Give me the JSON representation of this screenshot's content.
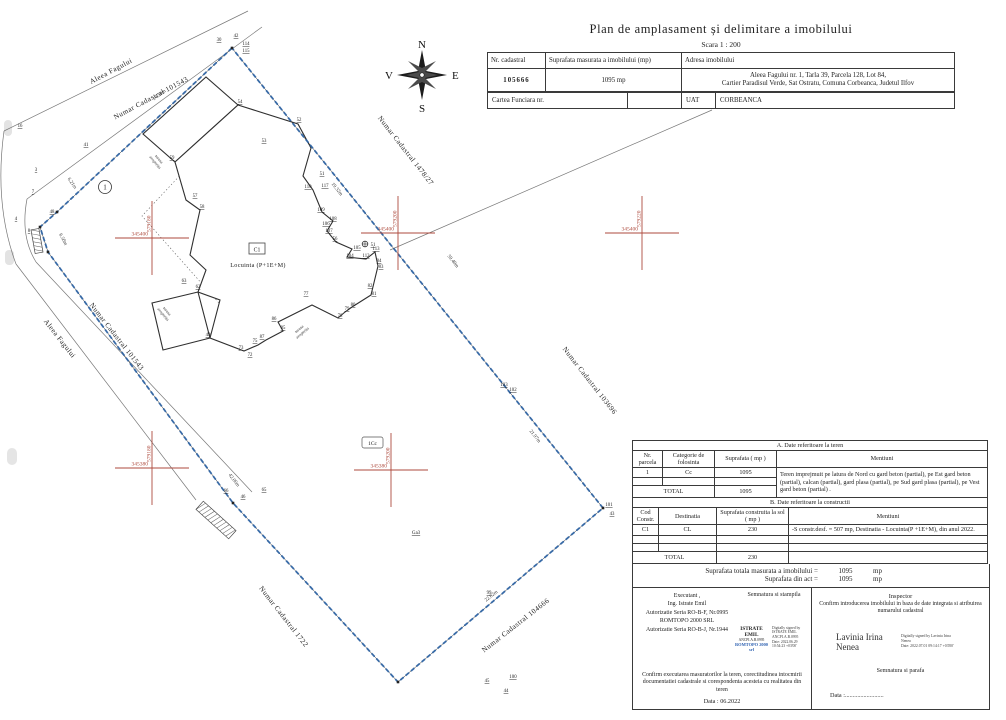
{
  "header": {
    "title": "Plan de amplasament și delimitare a imobilului",
    "scale": "Scara 1 : 200"
  },
  "top_table": {
    "col_nr_cadastral": "Nr. cadastral",
    "col_suprafata": "Suprafata masurata a imobilului (mp)",
    "col_adresa": "Adresa  imobilului",
    "nr_cadastral": "105666",
    "suprafata": "1095 mp",
    "adresa_line1": "Aleea Fagului nr. 1, Tarla 39, Parcela 128, Lot 84,",
    "adresa_line2": "Cartier Paradisul Verde, Sat Ostratu, Comuna Corbeanca, Judetul Ilfov",
    "cartea_funciara_label": "Cartea Funciara  nr.",
    "uat_label": "UAT",
    "uat_value": "CORBEANCA"
  },
  "compass": {
    "n": "N",
    "s": "S",
    "e": "E",
    "w": "V"
  },
  "table_a": {
    "title": "A. Date referitoare la teren",
    "headers": [
      "Nr. parcela",
      "Categorie de folosinta",
      "Suprafata ( mp )",
      "Mentiuni"
    ],
    "rows": [
      [
        "1",
        "Cc",
        "1095",
        "Teren imprejmuit pe latura de Nord cu gard beton (partial), pe Est gard beton (partial), calcan (partial), gard plasa (partial), pe Sud gard plasa (partial), pe Vest gard beton (partial) ."
      ]
    ],
    "total_label": "TOTAL",
    "total_value": "1095"
  },
  "table_b": {
    "title": "B. Date referitoare la constructii",
    "headers": [
      "Cod Constr.",
      "Destinatia",
      "Suprafata construita la sol ( mp )",
      "Mentiuni"
    ],
    "rows": [
      [
        "C1",
        "CL",
        "230",
        "-S constr.desf. = 507 mp, Destinatia - Locuinta(P +1E+M), din anul 2022."
      ]
    ],
    "total_label": "TOTAL",
    "total_value": "230"
  },
  "totals": {
    "line1_label": "Suprafata totala masurata a imobilului =",
    "line1_value": "1095",
    "line1_unit": "mp",
    "line2_label": "Suprafata din act =",
    "line2_value": "1095",
    "line2_unit": "mp"
  },
  "signatures": {
    "executant": {
      "lines": [
        "Executant ,",
        "Ing. Istrate Emil",
        "Autorizatie Seria RO-B-F, Nr.0995",
        "ROMTOPO 2000 SRL",
        "Autorizatie Seria RO-B-J, Nr.1944"
      ],
      "semnatura_label": "Semnatura si stampila",
      "stamp_name": "ISTRATE EMIL",
      "stamp_id": "ANCPI.A.B.0995",
      "stamp_company": "ROMTOPO 2000 srl",
      "stamp_details": "Digitally signed by ISTRATE EMIL ANCPI.A.B.0995",
      "stamp_date": "Date: 2022.06.29 10:54:23 +03'00'",
      "confirm_text": "Confirm executarea masuratorilor la teren, corectitudinea intocmirii documentatiei cadastrale si corespondenta acesteia cu realitatea din teren",
      "data_label": "Data :",
      "data_value": "06.2022"
    },
    "inspector": {
      "title": "Inspector",
      "confirm_text": "Confirm introducerea imobilului in baza de date integrata si atribuirea numarului cadastral",
      "sign_name": "Lavinia Irina Nenea",
      "sign_details": "Digitally signed by Lavinia Irina Nenea",
      "sign_date": "Date: 2022.07.01 09:14:17 +03'00'",
      "semnatura_label": "Semnatura si parafa",
      "data_label": "Data :........................."
    }
  },
  "plan": {
    "colors": {
      "boundary": "#2e64a5",
      "cross": "#ad4a3d",
      "road": "#777777",
      "building": "#2f2f2f"
    },
    "boundary": [
      [
        232,
        48
      ],
      [
        57,
        212
      ],
      [
        40,
        227
      ],
      [
        48,
        252
      ],
      [
        233,
        503
      ],
      [
        398,
        682
      ],
      [
        603,
        508
      ]
    ],
    "roads": [
      [
        [
          4,
          131
        ],
        [
          248,
          11
        ]
      ],
      [
        [
          27,
          199
        ],
        [
          262,
          27
        ]
      ],
      [
        [
          16,
          264
        ],
        [
          196,
          500
        ]
      ],
      [
        [
          36,
          262
        ],
        [
          252,
          492
        ]
      ],
      [
        [
          390,
          250
        ],
        [
          712,
          110
        ]
      ]
    ],
    "road_curves": [
      "M 4 131 Q -6 205 16 264",
      "M 27 199 Q 20 236 36 262"
    ],
    "culverts": [
      {
        "x": 216,
        "y": 520,
        "l": 44,
        "w": 11,
        "rot": 42
      },
      {
        "x": 37,
        "y": 241,
        "l": 24,
        "w": 8,
        "rot": 80
      }
    ],
    "building": {
      "main": [
        [
          238,
          105
        ],
        [
          298,
          124
        ],
        [
          311,
          148
        ],
        [
          303,
          176
        ],
        [
          313,
          190
        ],
        [
          322,
          212
        ],
        [
          333,
          221
        ],
        [
          327,
          231
        ],
        [
          336,
          242
        ],
        [
          352,
          249
        ],
        [
          347,
          257
        ],
        [
          366,
          259
        ],
        [
          375,
          252
        ],
        [
          378,
          266
        ],
        [
          371,
          295
        ],
        [
          352,
          307
        ],
        [
          345,
          312
        ],
        [
          338,
          318
        ],
        [
          312,
          305
        ],
        [
          278,
          322
        ],
        [
          283,
          331
        ],
        [
          266,
          340
        ],
        [
          258,
          345
        ],
        [
          244,
          351
        ],
        [
          210,
          338
        ],
        [
          220,
          300
        ],
        [
          198,
          292
        ],
        [
          206,
          270
        ],
        [
          190,
          255
        ],
        [
          200,
          210
        ],
        [
          186,
          200
        ],
        [
          175,
          162
        ]
      ],
      "wings": [
        [
          [
            175,
            162
          ],
          [
            238,
            105
          ],
          [
            206,
            77
          ],
          [
            143,
            134
          ]
        ],
        [
          [
            210,
            338
          ],
          [
            198,
            292
          ],
          [
            152,
            303
          ],
          [
            163,
            350
          ]
        ]
      ],
      "dotted": [
        [
          230,
          122
        ],
        [
          345,
          252
        ],
        [
          257,
          346
        ],
        [
          142,
          216
        ]
      ]
    },
    "crosses": [
      {
        "x": 152,
        "y": 238,
        "h": "345400",
        "v": "579180"
      },
      {
        "x": 398,
        "y": 233,
        "h": "345400",
        "v": "579200"
      },
      {
        "x": 642,
        "y": 233,
        "h": "345400",
        "v": "579220"
      },
      {
        "x": 152,
        "y": 468,
        "h": "345380",
        "v": "579180"
      },
      {
        "x": 391,
        "y": 470,
        "h": "345380",
        "v": "579200"
      }
    ],
    "parcel_texts": [
      [
        "Aleea Fagului",
        112,
        73,
        -28
      ],
      [
        "Numar Cadastral 101543",
        152,
        100,
        -28
      ],
      [
        "Aleea Fagului",
        58,
        340,
        52
      ],
      [
        "Numar Cadastral 101543",
        115,
        338,
        52
      ],
      [
        "Numar Cadastral 1478/27",
        404,
        152,
        52
      ],
      [
        "Numar Cadastral 103696",
        588,
        382,
        52
      ],
      [
        "Numar Cadastral 104666",
        517,
        627,
        -38
      ],
      [
        "Numar Cadastral 1722",
        282,
        618,
        52
      ]
    ],
    "dimensions": [
      [
        "14.50m",
        160,
        96,
        -37
      ],
      [
        "6.21m",
        71,
        184,
        55
      ],
      [
        "6.50m",
        62,
        240,
        62
      ],
      [
        "19.32m",
        336,
        190,
        51
      ],
      [
        "59.40m",
        452,
        262,
        51
      ],
      [
        "21.97m",
        534,
        437,
        51
      ],
      [
        "22.02m",
        492,
        597,
        -39
      ],
      [
        "42.06m",
        233,
        481,
        52
      ]
    ],
    "points": [
      [
        "16",
        20,
        127
      ],
      [
        "41",
        86,
        146
      ],
      [
        "3",
        36,
        171
      ],
      [
        "7",
        33,
        193
      ],
      [
        "48",
        52,
        213
      ],
      [
        "4",
        16,
        220
      ],
      [
        "8",
        29,
        232
      ],
      [
        "30",
        219,
        41
      ],
      [
        "42",
        236,
        37
      ],
      [
        "114",
        246,
        45
      ],
      [
        "115",
        246,
        52
      ],
      [
        "54",
        240,
        103
      ],
      [
        "52",
        299,
        121
      ],
      [
        "53",
        264,
        142
      ],
      [
        "59",
        172,
        159
      ],
      [
        "57",
        195,
        197
      ],
      [
        "58",
        202,
        208
      ],
      [
        "51",
        322,
        175
      ],
      [
        "110",
        308,
        188
      ],
      [
        "117",
        325,
        187
      ],
      [
        "109",
        321,
        211
      ],
      [
        "108",
        333,
        220
      ],
      [
        "106",
        326,
        225
      ],
      [
        "107",
        329,
        232
      ],
      [
        "56",
        335,
        240
      ],
      [
        "105",
        357,
        249
      ],
      [
        "104",
        350,
        257
      ],
      [
        "112",
        366,
        257
      ],
      [
        "113",
        376,
        250
      ],
      [
        "84",
        379,
        262
      ],
      [
        "83",
        381,
        268
      ],
      [
        "82",
        370,
        287
      ],
      [
        "81",
        374,
        295
      ],
      [
        "80",
        353,
        306
      ],
      [
        "79",
        347,
        310
      ],
      [
        "78",
        340,
        317
      ],
      [
        "77",
        306,
        295
      ],
      [
        "86",
        274,
        320
      ],
      [
        "85",
        283,
        329
      ],
      [
        "87",
        262,
        338
      ],
      [
        "75",
        255,
        342
      ],
      [
        "73",
        241,
        349
      ],
      [
        "72",
        250,
        356
      ],
      [
        "49",
        208,
        336
      ],
      [
        "62",
        198,
        288
      ],
      [
        "63",
        184,
        282
      ],
      [
        "65",
        264,
        491
      ],
      [
        "66",
        226,
        492
      ],
      [
        "46",
        243,
        498
      ],
      [
        "99",
        489,
        594
      ],
      [
        "45",
        487,
        682
      ],
      [
        "100",
        513,
        678
      ],
      [
        "44",
        506,
        692
      ],
      [
        "43",
        612,
        515
      ],
      [
        "101",
        609,
        506
      ],
      [
        "103",
        504,
        386
      ],
      [
        "102",
        513,
        391
      ]
    ],
    "terasa_labels": [
      [
        "terasa acoperita",
        158,
        160,
        50
      ],
      [
        "terasa acoperita",
        166,
        312,
        50
      ],
      [
        "terasa acoperita",
        300,
        330,
        -40
      ]
    ],
    "misc": {
      "parcel_circle_label": "1",
      "cc_label": "1Cc",
      "building_code": "C1",
      "building_name": "Locuinta  (P+1E+M)",
      "ga3_label": "Ga3",
      "station_label": "51"
    }
  }
}
